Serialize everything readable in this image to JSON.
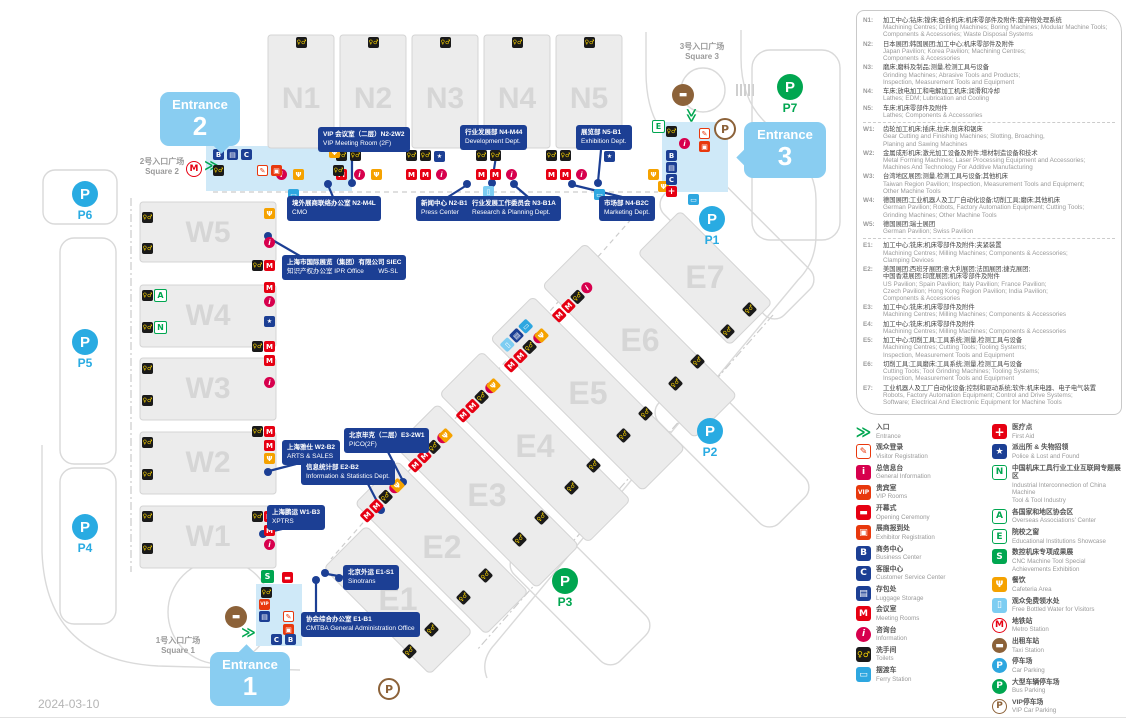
{
  "date": "2024-03-10",
  "map": {
    "halls_north": [
      "N1",
      "N2",
      "N3",
      "N4",
      "N5"
    ],
    "halls_west": [
      "W5",
      "W4",
      "W3",
      "W2",
      "W1"
    ],
    "halls_east": [
      "E1",
      "E2",
      "E3",
      "E4",
      "E5",
      "E6",
      "E7"
    ],
    "parking": [
      "P1",
      "P2",
      "P3",
      "P4",
      "P5",
      "P6",
      "P7"
    ],
    "entrances": [
      {
        "label": "Entrance",
        "number": "1"
      },
      {
        "label": "Entrance",
        "number": "2"
      },
      {
        "label": "Entrance",
        "number": "3"
      }
    ],
    "squares": [
      {
        "zh": "1号入口广场",
        "en": "Square 1"
      },
      {
        "zh": "2号入口广场",
        "en": "Square 2"
      },
      {
        "zh": "3号入口广场",
        "en": "Square 3"
      }
    ],
    "labels": [
      {
        "zh": "VIP 会议室（二层）N2-2W2",
        "en": "VIP Meeting Room (2F)"
      },
      {
        "zh": "行业发展部 N4-M44",
        "en": "Development Dept."
      },
      {
        "zh": "展览部 N5-B1",
        "en": "Exhibition Dept."
      },
      {
        "zh": "境外展商联络办公室 N2-M4L",
        "en": "CMO"
      },
      {
        "zh": "新闻中心 N2-B1",
        "en": "Press Center"
      },
      {
        "zh": "行业发展工作委员会 N3-B1A",
        "en": "Research & Planning Dept."
      },
      {
        "zh": "市场部 N4-B2C",
        "en": "Marketing Dept."
      },
      {
        "zh": "上海市国际展览（集团）有限公司 SIEC",
        "en": "知识产权办公室 IPR Office        W5-SL"
      },
      {
        "zh": "上海雅仕 W2-B2",
        "en": "ARTS & SALES"
      },
      {
        "zh": "北京毕克（二层）E3-2W1",
        "en": "PICO(2F)"
      },
      {
        "zh": "信息统计部 E2-B2",
        "en": "Information & Statistics Dept."
      },
      {
        "zh": "上海鹏运 W1-B3",
        "en": "XPTRS"
      },
      {
        "zh": "北京外运 E1-S1",
        "en": "Sinotrans"
      },
      {
        "zh": "协会综合办公室 E1-B1",
        "en": "CMTBA General Administration Office"
      }
    ],
    "icon_glyphs": {
      "meeting-rooms-icon": "M",
      "information-icon": "i",
      "toilets-icon": "♀♂",
      "cafeteria-icon": "fork-knife",
      "ferry-station-icon": "bus",
      "free-water-icon": "bottle",
      "business-center-icon": "B",
      "customer-service-icon": "C",
      "luggage-storage-icon": "briefcase",
      "police-icon": "badge",
      "first-aid-icon": "cross",
      "vip-room-icon": "VIP",
      "opening-ceremony-icon": "ribbon",
      "visitor-registration-icon": "pen",
      "exhibitor-registration-icon": "desk",
      "cnc-achievements-icon": "S",
      "metro-station-icon": "M",
      "taxi-station-icon": "car",
      "vip-parking-icon": "P",
      "overseas-associations-icon": "A",
      "industrial-internet-icon": "N",
      "educational-institutions-icon": "E",
      "entrance-arrows-icon": "green-arrows",
      "car-parking-icon": "P-blue",
      "bus-parking-icon": "P-green"
    }
  },
  "legend": {
    "halls_n": [
      {
        "code": "N1:",
        "zh": "加工中心;钻床;镗床;组合机床;机床零部件及附件;废弃物处理系统",
        "en": "Machining Centres; Drilling Machines; Boring Machines; Modular Machine Tools;\nComponents & Accessories; Waste Disposal Systems"
      },
      {
        "code": "N2:",
        "zh": "日本展团;韩国展团;加工中心;机床零部件及附件",
        "en": "Japan Pavilion; Korea Pavilion; Machining Centres;\nComponents & Accessories"
      },
      {
        "code": "N3:",
        "zh": "磨床;磨料及制品;测量,检测工具与设备",
        "en": "Grinding Machines; Abrasive Tools and Products;\nInspection, Measurement Tools and Equipment"
      },
      {
        "code": "N4:",
        "zh": "车床;放电加工和电解加工机床;润滑和冷却",
        "en": "Lathes; EDM; Lubrication and Cooling"
      },
      {
        "code": "N5:",
        "zh": "车床;机床零部件及附件",
        "en": "Lathes; Components & Accessories"
      }
    ],
    "halls_w": [
      {
        "code": "W1:",
        "zh": "齿轮加工机床;插床,拉床,刨床和锯床",
        "en": "Gear Cutting and Finishing Machines; Slotting, Broaching,\nPlaning and Sawing Machines"
      },
      {
        "code": "W2:",
        "zh": "金属成形机床;激光加工设备及附件;增材制造设备和技术",
        "en": "Metal Forming Machines; Laser Processing Equipment and Accessories;\nMachines And Technology For Additive Manufacturing"
      },
      {
        "code": "W3:",
        "zh": "台湾地区展团;测量,检测工具与设备;其他机床",
        "en": "Taiwan Region Pavilion; Inspection, Measurement Tools and Equipment;\nOther Machine Tools"
      },
      {
        "code": "W4:",
        "zh": "德国展团;工业机器人及工厂自动化设备;切削工具;磨床;其他机床",
        "en": "German Pavilion; Robots, Factory Automation Equipment; Cutting Tools;\nGrinding Machines; Other Machine Tools"
      },
      {
        "code": "W5:",
        "zh": "德国展团;瑞士展团",
        "en": "German Pavilion; Swiss Pavilion"
      }
    ],
    "halls_e": [
      {
        "code": "E1:",
        "zh": "加工中心;铣床;机床零部件及附件;夹紧装置",
        "en": "Machining Centres; Milling Machines; Components & Accessories;\nClamping Devices"
      },
      {
        "code": "E2:",
        "zh": "美国展团;西班牙展团;意大利展团;法国展团;捷克展团;\n中国香港展团;印度展团;机床零部件及附件",
        "en": "US Pavilion; Spain Pavilion; Italy Pavilion; France Pavilion;\nCzech Pavilion; Hong Kong Region Pavilion; India Pavilion;\nComponents & Accessories"
      },
      {
        "code": "E3:",
        "zh": "加工中心;铣床;机床零部件及附件",
        "en": "Machining Centres; Milling Machines; Components & Accessories"
      },
      {
        "code": "E4:",
        "zh": "加工中心;铣床;机床零部件及附件",
        "en": "Machining Centres; Milling Machines; Components & Accessories"
      },
      {
        "code": "E5:",
        "zh": "加工中心;切削工具;工具系统;测量,检测工具与设备",
        "en": "Machining Centres; Cutting Tools; Tooling Systems;\nInspection, Measurement Tools and Equipment"
      },
      {
        "code": "E6:",
        "zh": "切削工具;工具磨床;工具系统;测量,检测工具与设备",
        "en": "Cutting Tools; Tool Grinding Machines; Tooling Systems;\nInspection, Measurement Tools and Equipment"
      },
      {
        "code": "E7:",
        "zh": "工业机器人及工厂自动化设备;控制和驱动系统;软件;机床电器、电子电气装置",
        "en": "Robots, Factory Automation Equipment; Control and Drive Systems;\nSoftware; Electrical And Electronic Equipment for Machine Tools"
      }
    ],
    "facilities_left": [
      {
        "name": "entrance-icon",
        "glyph": "≫",
        "style": "background:none;color:#00a650;font-size:15px",
        "zh": "入口",
        "en": "Entrance"
      },
      {
        "name": "visitor-registration-icon",
        "glyph": "✎",
        "style": "background:#fff;color:#e8380d;border:1px solid #e8380d",
        "zh": "观众登录",
        "en": "Visitor Registration"
      },
      {
        "name": "general-information-icon",
        "glyph": "i",
        "style": "background:#d7004d",
        "zh": "总信息台",
        "en": "General Information"
      },
      {
        "name": "vip-room-icon",
        "glyph": "VIP",
        "style": "background:#e8380d;font-size:6px",
        "zh": "贵宾室",
        "en": "VIP Rooms"
      },
      {
        "name": "opening-ceremony-icon",
        "glyph": "▬",
        "style": "background:#e60012",
        "zh": "开幕式",
        "en": "Opening Ceremony"
      },
      {
        "name": "exhibitor-registration-icon",
        "glyph": "▣",
        "style": "background:#e8380d",
        "zh": "展商报到处",
        "en": "Exhibitor Registration"
      },
      {
        "name": "business-center-icon",
        "glyph": "B",
        "style": "background:#1c3f94",
        "zh": "商务中心",
        "en": "Business Center"
      },
      {
        "name": "customer-service-icon",
        "glyph": "C",
        "style": "background:#1c3f94",
        "zh": "客服中心",
        "en": "Customer Service Center"
      },
      {
        "name": "luggage-storage-icon",
        "glyph": "▤",
        "style": "background:#1c3f94",
        "zh": "存包处",
        "en": "Luggage Storage"
      },
      {
        "name": "meeting-rooms-icon",
        "glyph": "M",
        "style": "background:#e60012",
        "zh": "会议室",
        "en": "Meeting Rooms"
      },
      {
        "name": "information-icon",
        "glyph": "i",
        "style": "background:#d7004d;border-radius:50%;font-style:italic",
        "zh": "咨询台",
        "en": "Information"
      },
      {
        "name": "toilets-icon",
        "glyph": "♀♂",
        "style": "background:#1a1a1a;color:#ffd800;font-size:8px",
        "zh": "洗手间",
        "en": "Toilets"
      },
      {
        "name": "ferry-station-icon",
        "glyph": "▭",
        "style": "background:#2ea7e0",
        "zh": "摆渡车",
        "en": "Ferry Station"
      }
    ],
    "facilities_right": [
      {
        "name": "first-aid-icon",
        "glyph": "+",
        "style": "background:#e60012;font-size:12px",
        "zh": "医疗点",
        "en": "First Aid"
      },
      {
        "name": "police-icon",
        "glyph": "★",
        "style": "background:#1c3f94",
        "zh": "派出所 & 失物招领",
        "en": "Police & Lost and Found"
      },
      {
        "name": "industrial-internet-icon",
        "glyph": "N",
        "style": "background:#fff;color:#00a650;border:1px solid #00a650",
        "zh": "中国机床工具行业工业互联网专题展区",
        "en": "Industrial Interconnection of China Machine\nTool & Tool Industry"
      },
      {
        "name": "overseas-associations-icon",
        "glyph": "A",
        "style": "background:#fff;color:#00a650;border:1px solid #00a650",
        "zh": "各国家和地区协会区",
        "en": "Overseas Associations' Center"
      },
      {
        "name": "educational-institutions-icon",
        "glyph": "E",
        "style": "background:#fff;color:#00a650;border:1px solid #00a650",
        "zh": "院校之窗",
        "en": "Educational Institutions Showcase"
      },
      {
        "name": "cnc-achievements-icon",
        "glyph": "S",
        "style": "background:#00a650",
        "zh": "数控机床专项成果展",
        "en": "CNC Machine Tool Special Achievements Exhibition"
      },
      {
        "name": "cafeteria-icon",
        "glyph": "Ψ",
        "style": "background:#f5a200",
        "zh": "餐饮",
        "en": "Cafeteria Area"
      },
      {
        "name": "free-water-icon",
        "glyph": "▯",
        "style": "background:#7dcdf2",
        "zh": "观众免费领水处",
        "en": "Free Bottled Water for Visitors"
      },
      {
        "name": "metro-station-icon",
        "glyph": "M",
        "style": "background:#fff;color:#e60012;border:1px solid #e60012;border-radius:50%",
        "zh": "地铁站",
        "en": "Metro Station"
      },
      {
        "name": "taxi-station-icon",
        "glyph": "▬",
        "style": "background:#8c6239;border-radius:50%",
        "zh": "出租车站",
        "en": "Taxi Station"
      },
      {
        "name": "car-parking-icon",
        "glyph": "P",
        "style": "background:#2ea7e0;border-radius:50%",
        "zh": "停车场",
        "en": "Car Parking"
      },
      {
        "name": "bus-parking-icon",
        "glyph": "P",
        "style": "background:#00a650;border-radius:50%",
        "zh": "大型车辆停车场",
        "en": "Bus Parking"
      },
      {
        "name": "vip-parking-icon",
        "glyph": "P",
        "style": "background:#fff;color:#8c6239;border:1px solid #8c6239;border-radius:50%",
        "zh": "VIP停车场",
        "en": "VIP Car Parking"
      }
    ]
  }
}
